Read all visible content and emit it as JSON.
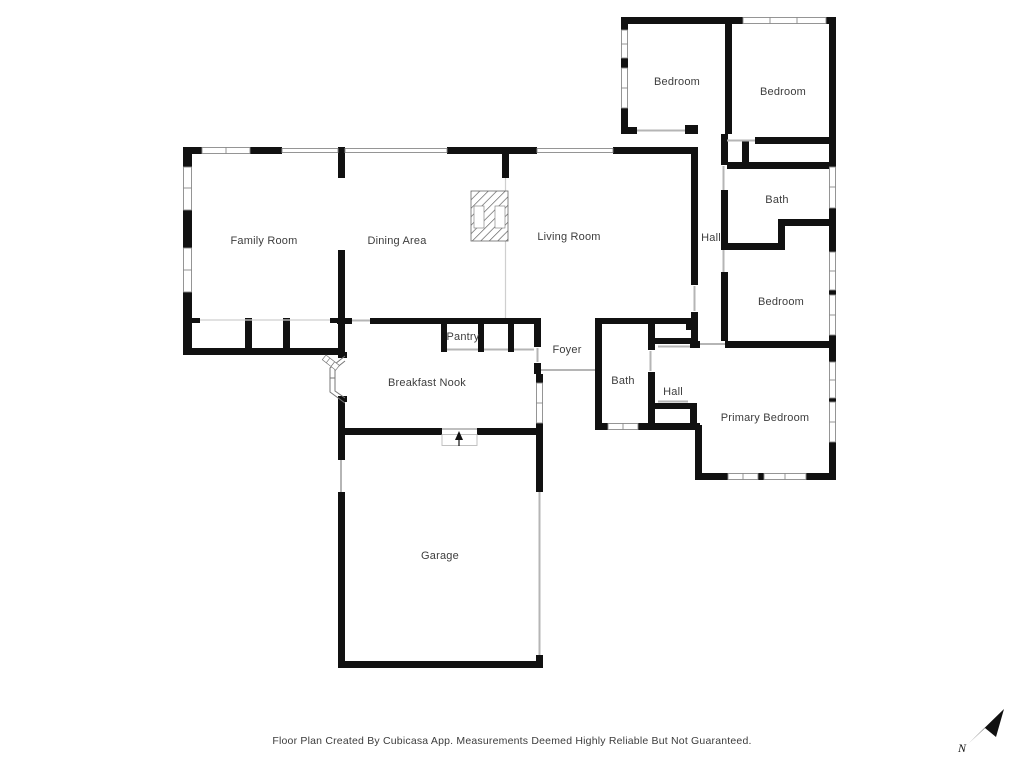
{
  "footer": {
    "text": "Floor Plan Created By Cubicasa App. Measurements Deemed Highly Reliable But Not Guaranteed."
  },
  "compass": {
    "label": "N"
  },
  "colors": {
    "wall": "#111111",
    "label": "#3d3d3d",
    "window_stroke": "#8a8a8a",
    "door_line": "#b5b5b5"
  },
  "rooms": [
    {
      "id": "bedroom-1",
      "label": "Bedroom"
    },
    {
      "id": "bedroom-2",
      "label": "Bedroom"
    },
    {
      "id": "bath-upper",
      "label": "Bath"
    },
    {
      "id": "hall-upper",
      "label": "Hall"
    },
    {
      "id": "bedroom-3",
      "label": "Bedroom"
    },
    {
      "id": "family-room",
      "label": "Family Room"
    },
    {
      "id": "dining-area",
      "label": "Dining Area"
    },
    {
      "id": "living-room",
      "label": "Living Room"
    },
    {
      "id": "pantry",
      "label": "Pantry"
    },
    {
      "id": "foyer",
      "label": "Foyer"
    },
    {
      "id": "breakfast-nook",
      "label": "Breakfast Nook"
    },
    {
      "id": "bath-lower",
      "label": "Bath"
    },
    {
      "id": "hall-lower",
      "label": "Hall"
    },
    {
      "id": "primary-bedroom",
      "label": "Primary Bedroom"
    },
    {
      "id": "garage",
      "label": "Garage"
    }
  ]
}
